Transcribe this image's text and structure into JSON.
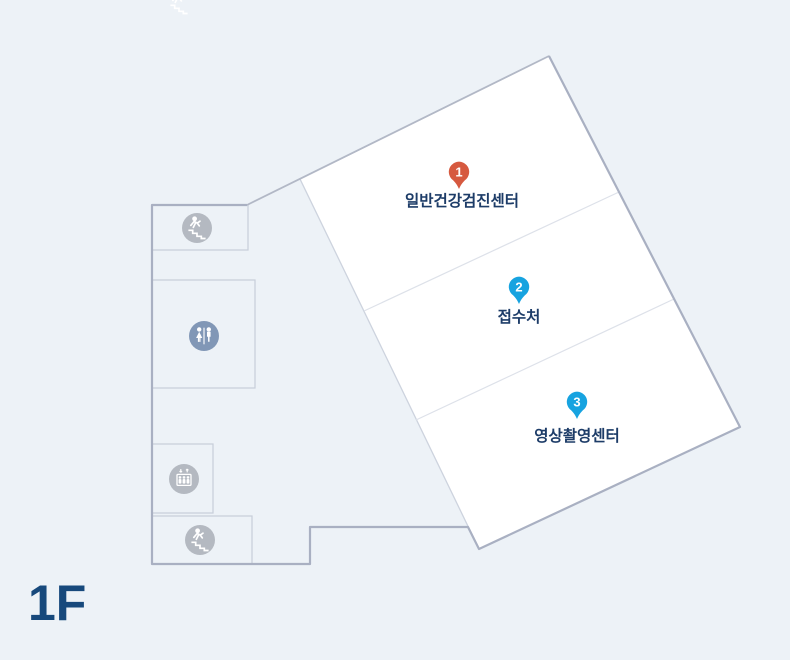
{
  "floor_label": "1F",
  "markers": [
    {
      "number": "1",
      "label": "일반건강검진센터",
      "pin_color": "#d6593f"
    },
    {
      "number": "2",
      "label": "접수처",
      "pin_color": "#17a3e0"
    },
    {
      "number": "3",
      "label": "영상촬영센터",
      "pin_color": "#17a3e0"
    }
  ],
  "facilities": [
    {
      "icon": "stairs-icon"
    },
    {
      "icon": "restroom-icon"
    },
    {
      "icon": "elevator-icon"
    },
    {
      "icon": "stairs-icon"
    }
  ],
  "colors": {
    "background": "#edf2f7",
    "room_fill": "#ffffff",
    "outline_strong": "#a9b0c2",
    "outline_light": "#cdd3de",
    "room_divider": "#dde1e9",
    "marker_label_text": "#1d3c68",
    "floor_label_text": "#17497c",
    "facility_icon_gray": "#b4b9c1",
    "restroom_icon_blue": "#8197b6",
    "pin_red": "#d6593f",
    "pin_blue": "#17a3e0"
  }
}
